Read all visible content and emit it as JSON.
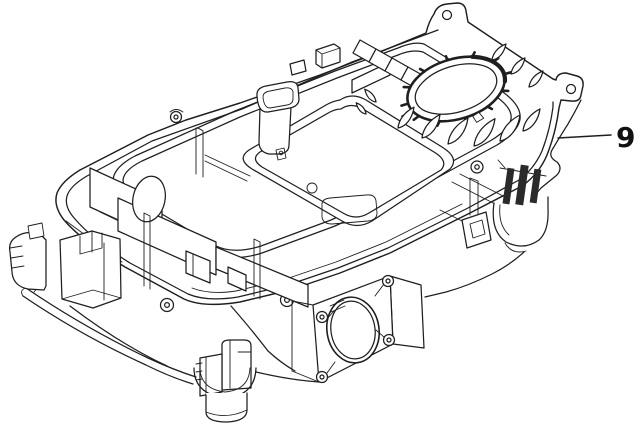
{
  "figure": {
    "background_color": "#ffffff",
    "line_color": "#1f1f1f",
    "description": "Isometric black-and-white technical line drawing of a robotic lawnmower chassis tub viewed open from above: outer rim with sealing-gasket channel, toothed cutting-disc ring with cooling fins, centre funnel tube, rounded battery tray, interior partition walls, front wheel-motor mounting plate with large circular opening and four screw bosses, and suspension posts at the corners."
  },
  "callout": {
    "number": "9",
    "leader": {
      "x1": 558,
      "y1": 138,
      "x2": 611,
      "y2": 135
    },
    "label": {
      "x": 616,
      "y": 147,
      "font_size": 28
    }
  }
}
